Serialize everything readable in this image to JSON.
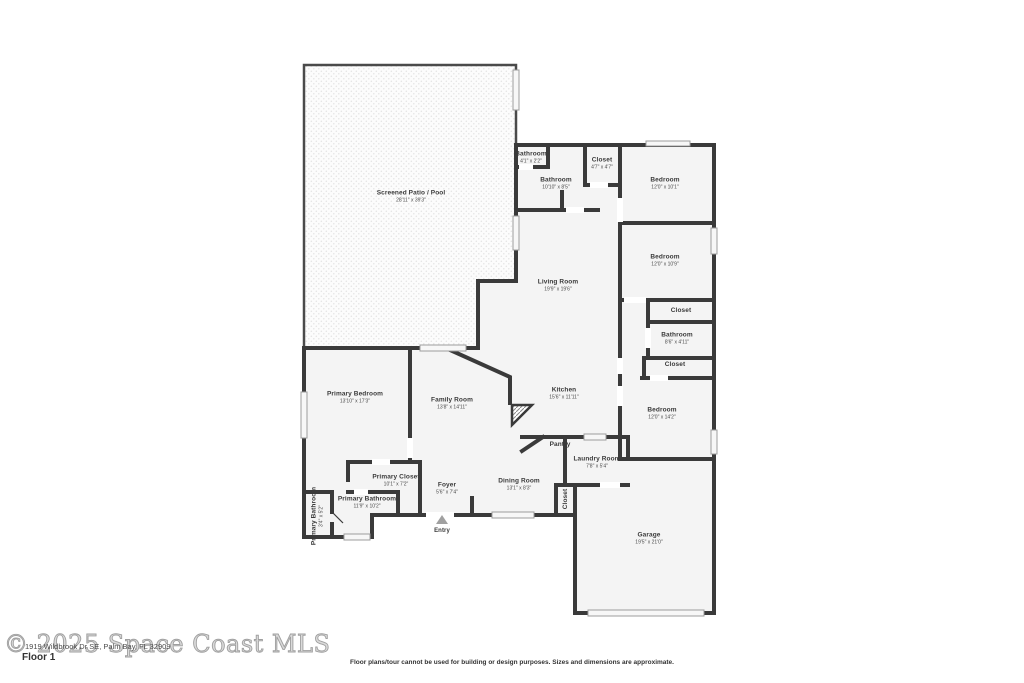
{
  "footer": {
    "floor_label": "Floor 1",
    "watermark": "© 2025 Space Coast MLS",
    "address": "1919 Wildbrook Dr SE, Palm Bay, FL 32909",
    "disclaimer": "Floor plans/tour cannot be used for building or design purposes. Sizes and dimensions are approximate."
  },
  "colors": {
    "wall": "#3a3a3a",
    "room_fill": "#f4f4f4",
    "window": "#f7f7f7",
    "text": "#3a3a3a"
  },
  "rooms": [
    {
      "name": "Screened Patio / Pool",
      "dims": "28'11\" x 39'3\""
    },
    {
      "name": "Bathroom",
      "dims": "4'1\" x 2'2\""
    },
    {
      "name": "Bathroom",
      "dims": "10'10\" x 8'5\""
    },
    {
      "name": "Closet",
      "dims": "4'7\" x 4'7\""
    },
    {
      "name": "Bedroom",
      "dims": "12'0\" x 10'1\""
    },
    {
      "name": "Bedroom",
      "dims": "12'0\" x 10'9\""
    },
    {
      "name": "Living Room",
      "dims": "19'9\" x 19'6\""
    },
    {
      "name": "Closet",
      "dims": ""
    },
    {
      "name": "Bathroom",
      "dims": "8'6\" x 4'11\""
    },
    {
      "name": "Closet",
      "dims": ""
    },
    {
      "name": "Bedroom",
      "dims": "12'0\" x 14'2\""
    },
    {
      "name": "Kitchen",
      "dims": "15'6\" x 11'11\""
    },
    {
      "name": "Family Room",
      "dims": "13'8\" x 14'11\""
    },
    {
      "name": "Primary Bedroom",
      "dims": "13'10\" x 17'3\""
    },
    {
      "name": "Primary Closet",
      "dims": "10'1\" x 7'2\""
    },
    {
      "name": "Primary Bathroom",
      "dims": "11'9\" x 10'2\""
    },
    {
      "name": "Primary Bathroom",
      "dims": "3'4\" x 5'2\""
    },
    {
      "name": "Foyer",
      "dims": "5'6\" x 7'4\""
    },
    {
      "name": "Dining Room",
      "dims": "13'1\" x 8'3\""
    },
    {
      "name": "Pantry",
      "dims": ""
    },
    {
      "name": "Laundry Room",
      "dims": "7'8\" x 5'4\""
    },
    {
      "name": "Closet",
      "dims": ""
    },
    {
      "name": "Garage",
      "dims": "19'5\" x 21'0\""
    },
    {
      "name": "Entry",
      "dims": ""
    }
  ]
}
